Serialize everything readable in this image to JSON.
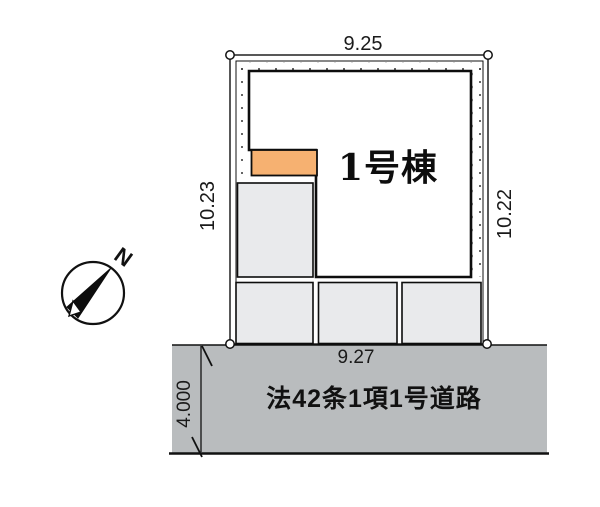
{
  "plan": {
    "building": {
      "label": "1号棟"
    },
    "dimensions": {
      "top": "9.25",
      "left": "10.23",
      "right": "10.22",
      "bottom": "9.27",
      "road_width": "4.000"
    },
    "road": {
      "label": "法42条1項1号道路",
      "color": "#b9bcbe"
    },
    "compass": {
      "north_label": "N"
    },
    "colors": {
      "entrance": "#f6b171",
      "parking": "#e9eaec",
      "line": "#111111"
    }
  }
}
